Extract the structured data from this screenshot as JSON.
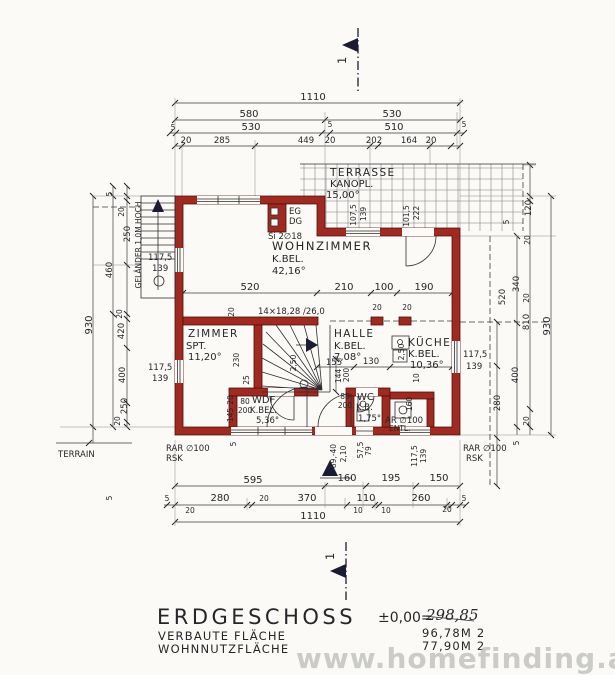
{
  "title_block": {
    "floor_label": "ERDGESCHOSS",
    "row1_label": "VERBAUTE FLÄCHE",
    "row1_value": "96,78M 2",
    "row2_label": "WOHNNUTZFLÄCHE",
    "row2_value": "77,90M 2",
    "level_prefix": "±0,00=",
    "level_value": "298,85",
    "watermark": "www.homefinding.at"
  },
  "rooms": {
    "terrasse": {
      "name": "TERRASSE",
      "sub": "KANOPL.",
      "area": "15,00°"
    },
    "wohnzimmer": {
      "name": "WOHNZIMMER",
      "sub": "K.BEL.",
      "area": "42,16°"
    },
    "zimmer": {
      "name": "ZIMMER",
      "sub": "SPT.",
      "area": "11,20°"
    },
    "halle": {
      "name": "HALLE",
      "sub": "K.BEL.",
      "area": "7,08°"
    },
    "kueche": {
      "name": "KÜCHE",
      "sub": "K.BEL.",
      "area": "10,36°"
    },
    "wdf": {
      "name": "WDF",
      "sub": "K.BEL.",
      "area": "5,36°"
    },
    "wc": {
      "name": "WC",
      "sub": "K.B.",
      "area": "1,75°"
    }
  },
  "annotations": {
    "section_mark": "1",
    "chimney_eg": "EG",
    "chimney_dg": "DG",
    "chimney_note": "Si 2∅18",
    "stair_note": "14×18,28 /26,0",
    "railing_note": "GELÄNDER 1,0M HOCH",
    "terrain": "TERRAIN",
    "drain_left_1": "RAR ∅100",
    "drain_left_2": "RSK",
    "drain_right_1": "RAR ∅100",
    "drain_right_2": "RSK",
    "vent_1": "AR ∅100",
    "vent_2": "ENTL."
  },
  "dims": {
    "top": {
      "total": "1110",
      "left": "580",
      "right": "530",
      "e5a": "5",
      "l530": "530",
      "e5b": "5",
      "r510": "510",
      "e5c": "5",
      "s20a": "20",
      "s285": "285",
      "s449": "449",
      "s20b": "20",
      "s202": "202",
      "s164": "164",
      "s20c": "20"
    },
    "terrace": {
      "w1a": "107,5",
      "w1b": "139",
      "w2a": "101,5",
      "w2b": "222"
    },
    "mid": {
      "d520": "520",
      "d210": "210",
      "d100": "100",
      "d190": "190",
      "r20": "20",
      "p20a": "20",
      "p20b": "20"
    },
    "zimmer": {
      "h230": "230",
      "s25": "25"
    },
    "halle": {
      "s155": "155",
      "s130": "130",
      "v144": "144",
      "v200": "200",
      "r250": "2,50"
    },
    "kueche": {
      "win1": "117,5",
      "win2": "139",
      "r250": "2,50",
      "s10": "10",
      "s160": "160"
    },
    "wdf": {
      "door_w": "80",
      "door_h": "200",
      "s20": "20",
      "s145": "145"
    },
    "wc": {
      "door_w": "80",
      "door_h": "200"
    },
    "left": {
      "e5": "5",
      "s20a": "20",
      "s250a": "250",
      "s460": "460",
      "total": "930",
      "s20b": "20",
      "s420": "420",
      "s400": "400",
      "s250b": "250",
      "s20c": "20",
      "win1a": "117,5",
      "win1b": "139",
      "win2a": "117,5",
      "win2b": "139"
    },
    "right": {
      "s120": "120",
      "e5a": "5",
      "s20a": "20",
      "s340": "340",
      "s520": "520",
      "s20b": "20",
      "s810": "810",
      "total": "930",
      "s400": "400",
      "s280": "280",
      "s20c": "20",
      "e5b": "5"
    },
    "bottom": {
      "s595": "595",
      "s160": "160",
      "s195": "195",
      "s150": "150",
      "e5a": "5",
      "s280": "280",
      "s20a": "20",
      "s20b": "20",
      "s370": "370",
      "s110": "110",
      "s10a": "10",
      "s10b": "10",
      "s260": "260",
      "s20c": "20",
      "e5b": "5",
      "total": "1110",
      "v1": "89,-40",
      "v2": "2,10",
      "v3": "57,5",
      "v4": "79",
      "v5": "117,5",
      "v6": "139",
      "r5a": "5",
      "r5b": "5"
    }
  }
}
